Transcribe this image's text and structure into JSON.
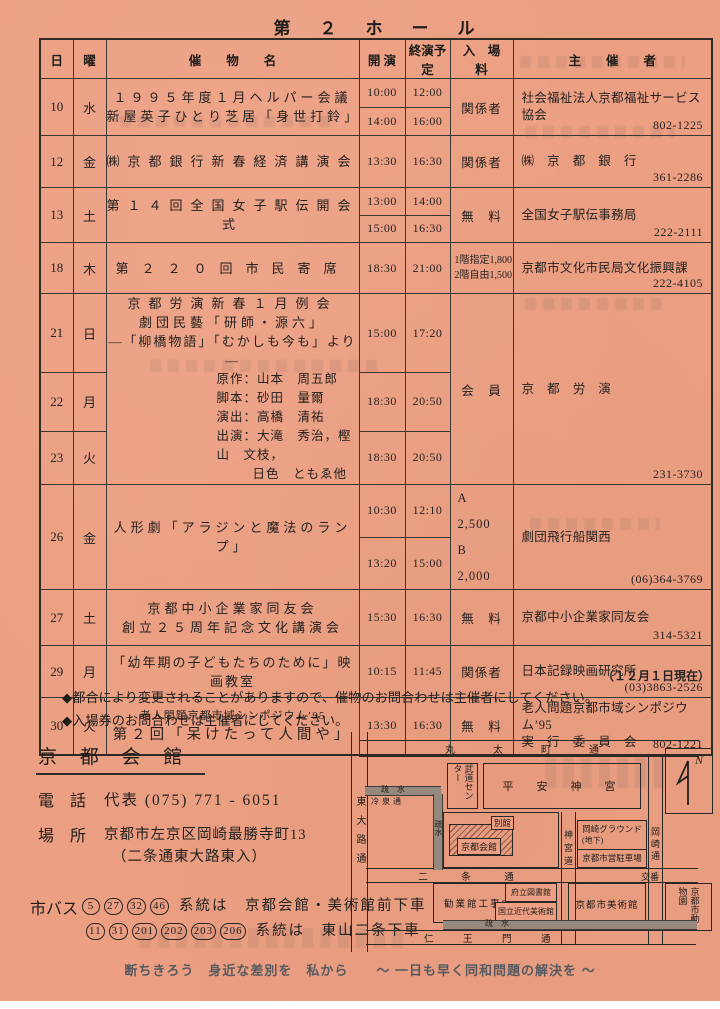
{
  "title": "第　２　ホ　ー　ル",
  "table": {
    "headers": {
      "day": "日",
      "weekday": "曜",
      "event": "催　　物　　名",
      "start": "開 演",
      "end": "終演予定",
      "fee": "入　場　料",
      "organizer": "主　　催　　者"
    },
    "groups": [
      {
        "days": [
          {
            "day": "10",
            "wd": "水",
            "h": 57,
            "times": [
              {
                "s": "10:00",
                "e": "12:00"
              },
              {
                "s": "14:00",
                "e": "16:00"
              }
            ]
          }
        ],
        "event": [
          {
            "t": "１９９５年度１月ヘルパー会議",
            "a": "c",
            "cls": "sp1"
          },
          {
            "t": "新屋英子ひとり芝居「身世打鈴」",
            "a": "c",
            "cls": "sp1"
          }
        ],
        "fee": [
          {
            "t": "関係者"
          }
        ],
        "org": [
          "社会福祉法人京都福祉サービス協会"
        ],
        "tel": "802-1225"
      },
      {
        "days": [
          {
            "day": "12",
            "wd": "金",
            "h": 52,
            "times": [
              {
                "s": "13:30",
                "e": "16:30"
              }
            ]
          }
        ],
        "event": [
          {
            "t": "㈱京都銀行新春経済講演会",
            "a": "c",
            "cls": "sp2"
          }
        ],
        "fee": [
          {
            "t": "関係者"
          }
        ],
        "org": [
          "㈱　京　都　銀　行"
        ],
        "tel": "361-2286"
      },
      {
        "days": [
          {
            "day": "13",
            "wd": "土",
            "h": 55,
            "times": [
              {
                "s": "13:00",
                "e": "14:00"
              },
              {
                "s": "15:00",
                "e": "16:30"
              }
            ]
          }
        ],
        "event": [
          {
            "t": "第１４回全国女子駅伝開会式",
            "a": "c",
            "cls": "sp2"
          }
        ],
        "fee": [
          {
            "t": "無　料"
          }
        ],
        "org": [
          "全国女子駅伝事務局"
        ],
        "tel": "222-2111"
      },
      {
        "days": [
          {
            "day": "18",
            "wd": "木",
            "h": 51,
            "times": [
              {
                "s": "18:30",
                "e": "21:00"
              }
            ]
          }
        ],
        "event": [
          {
            "t": "第２２０回市民寄席",
            "a": "c",
            "cls": "sp3"
          }
        ],
        "fee": [
          {
            "t": "1階指定1,800",
            "cls": "small"
          },
          {
            "t": "2階自由1,500",
            "cls": "small"
          }
        ],
        "org": [
          "京都市文化市民局文化振興課"
        ],
        "tel": "222-4105"
      },
      {
        "days": [
          {
            "day": "21",
            "wd": "日",
            "h": 70,
            "times": [
              {
                "s": "15:00",
                "e": "17:20"
              }
            ]
          },
          {
            "day": "22",
            "wd": "月",
            "h": 52,
            "times": [
              {
                "s": "18:30",
                "e": "20:50"
              }
            ]
          },
          {
            "day": "23",
            "wd": "火",
            "h": 47,
            "times": [
              {
                "s": "18:30",
                "e": "20:50"
              }
            ]
          }
        ],
        "event": [
          {
            "t": "京都労演新春１月例会",
            "a": "c",
            "cls": "sp2"
          },
          {
            "t": "劇団民藝「研師・源六」",
            "a": "c",
            "cls": "sp1"
          },
          {
            "t": "―「柳橋物語」「むかしも今も」より ―",
            "a": "c"
          },
          {
            "t": "原作：山本　周五郎",
            "a": "l"
          },
          {
            "t": "脚本：砂田　量爾",
            "a": "l"
          },
          {
            "t": "演出：高橋　清祐",
            "a": "l"
          },
          {
            "t": "出演：大滝　秀治，樫山　文枝，",
            "a": "l"
          },
          {
            "t": "日色　ともゑ他",
            "a": "l2"
          }
        ],
        "fee": [
          {
            "t": "会　員"
          }
        ],
        "org": [
          "京　都　労　演"
        ],
        "tel": "231-3730"
      },
      {
        "days": [
          {
            "day": "26",
            "wd": "金",
            "h": 53,
            "times": [
              {
                "s": "10:30",
                "e": "12:10"
              },
              {
                "s": "13:20",
                "e": "15:00"
              }
            ]
          }
        ],
        "event": [
          {
            "t": "人形劇「アラジンと魔法のランプ」",
            "a": "c",
            "cls": "sp1"
          }
        ],
        "fee": [
          {
            "t": "A　2,500",
            "cls": "ab"
          },
          {
            "t": "B　2,000",
            "cls": "ab"
          }
        ],
        "org": [
          "劇団飛行船関西"
        ],
        "tel": "(06)364-3769"
      },
      {
        "days": [
          {
            "day": "27",
            "wd": "土",
            "h": 56,
            "times": [
              {
                "s": "15:30",
                "e": "16:30"
              }
            ]
          }
        ],
        "event": [
          {
            "t": "京都中小企業家同友会",
            "a": "c",
            "cls": "sp1"
          },
          {
            "t": "創立２５周年記念文化講演会",
            "a": "c",
            "cls": "sp1"
          }
        ],
        "fee": [
          {
            "t": "無　料"
          }
        ],
        "org": [
          "京都中小企業家同友会"
        ],
        "tel": "314-5321"
      },
      {
        "days": [
          {
            "day": "29",
            "wd": "月",
            "h": 52,
            "times": [
              {
                "s": "10:15",
                "e": "11:45"
              }
            ]
          }
        ],
        "event": [
          {
            "t": "「幼年期の子どもたちのために」映画教室",
            "a": "c"
          }
        ],
        "fee": [
          {
            "t": "関係者"
          }
        ],
        "org": [
          "日本記録映画研究所"
        ],
        "tel": "(03)3863-2526"
      },
      {
        "days": [
          {
            "day": "30",
            "wd": "火",
            "h": 57,
            "times": [
              {
                "s": "13:30",
                "e": "16:30"
              }
            ]
          }
        ],
        "event": [
          {
            "t": "老人問題京都市域シンポジウム’95",
            "a": "c",
            "cls": "small"
          },
          {
            "t": "第２回「呆けたって人間や」",
            "a": "c",
            "cls": "sp1 big"
          }
        ],
        "fee": [
          {
            "t": "無　料"
          }
        ],
        "org": [
          "老人問題京都市域シンポジウム’95",
          "実　行　委　員　会"
        ],
        "tel": "802-1221"
      }
    ]
  },
  "as_of": "（１２月１日現在）",
  "notes": [
    "◆都合により変更されることがありますので、催物のお問合わせは主催者にしてください。",
    "◆入場券のお問合わせは主催者にしてください。"
  ],
  "venue": {
    "name": "京 都 会 館",
    "tel_label": "電　話",
    "tel_value": "代表 (075) 771 - 6051",
    "place_label": "場　所",
    "address1": "京都市左京区岡崎最勝寺町13",
    "address2": "（二条通東大路東入）",
    "bus_label": "市バス",
    "bus1_routes": [
      "5",
      "27",
      "32",
      "46"
    ],
    "bus1_text": "系統は　京都会館・美術館前下車",
    "bus2_routes": [
      "11",
      "31",
      "201",
      "202",
      "203",
      "206"
    ],
    "bus2_text": "系統は　東山二条下車"
  },
  "map": {
    "roads": {
      "marutamachi": "丸　太　町　通",
      "nijo": "二　条　通",
      "niomon": "仁　王　門　通",
      "higashioji": "東大路通",
      "jingumichi": "神宮道",
      "okazakidori": "岡崎通",
      "reisen": "冷泉通"
    },
    "water": {
      "sosui_top": "疏　水",
      "sosui_left": "疏水",
      "sosui_bottom": "疏　水"
    },
    "places": {
      "budo": "武道センター",
      "heian": "平　安　神　宮",
      "bekkan": "別館",
      "kaikan": "京都会館",
      "koban": "交番",
      "kangyokan": "勧業館工事中",
      "library": "府立図書館",
      "momak": "国立近代美術館",
      "ground": "岡崎グラウンド",
      "chika": "(地下)",
      "parking": "京都市営駐車場",
      "art": "京都市美術館",
      "zoo": "京都市動物園"
    },
    "compass": "N"
  },
  "footer": "断ちきろう　身近な差別を　私から　　〜 一日も早く同和問題の解決を 〜",
  "colors": {
    "paper": "#ec9f82",
    "ink": "#262220",
    "line": "#3b3733",
    "footer_gray": "#565a60"
  }
}
